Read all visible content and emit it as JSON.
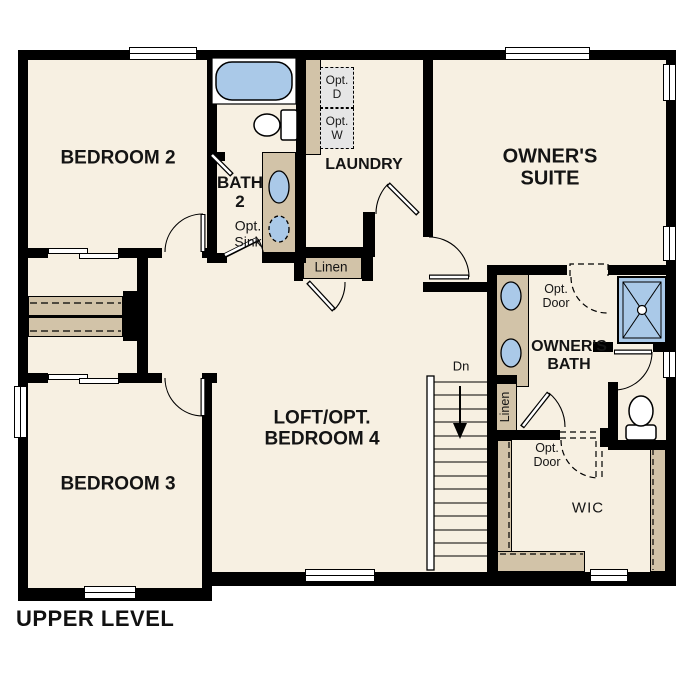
{
  "plan_title": "UPPER LEVEL",
  "colors": {
    "floor": "#f7f0e2",
    "wall": "#000000",
    "cabinet_tan": "#d2c3a8",
    "fixture_blue": "#aac9e8",
    "appliance_gray": "#e6e6e6"
  },
  "rooms": {
    "bedroom2": {
      "label": "BEDROOM 2"
    },
    "bath2": {
      "label": "BATH\n2",
      "opt_sink": "Opt.\nSink"
    },
    "laundry": {
      "label": "LAUNDRY",
      "opt_dryer": "Opt.\nD",
      "opt_washer": "Opt.\nW"
    },
    "owners_suite": {
      "label": "OWNER'S\nSUITE"
    },
    "loft": {
      "label": "LOFT/OPT.\nBEDROOM 4"
    },
    "bedroom3": {
      "label": "BEDROOM 3"
    },
    "owners_bath": {
      "label": "OWNER'S\nBATH",
      "opt_door": "Opt.\nDoor"
    },
    "wic": {
      "label": "WIC",
      "opt_door": "Opt.\nDoor"
    },
    "linen_hall": {
      "label": "Linen"
    },
    "linen_bath": {
      "label": "Linen"
    },
    "stairs": {
      "direction_label": "Dn"
    }
  }
}
